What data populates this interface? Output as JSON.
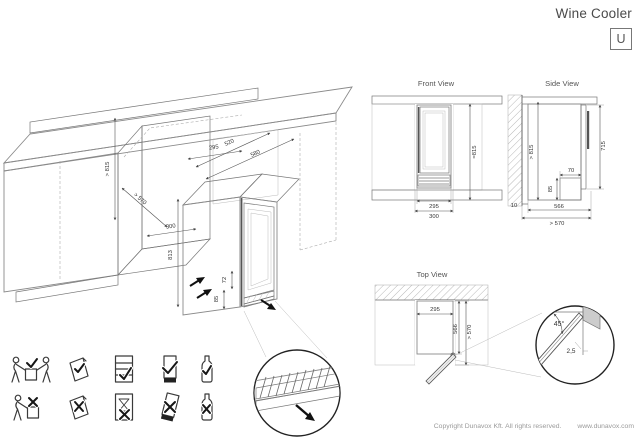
{
  "header": {
    "title": "Wine Cooler",
    "model_letter": "U"
  },
  "isometric": {
    "dim_niche_height": "> 815",
    "dim_niche_depth": "> 570",
    "dim_niche_width": "300",
    "dim_unit_width": "295",
    "dim_depth_inner": "520",
    "dim_depth_outer": "580",
    "dim_unit_height": "813",
    "dim_plinth_height": "72",
    "dim_vent_height": "85"
  },
  "front_view": {
    "title": "Front View",
    "dim_height": "≈815",
    "dim_unit_width": "295",
    "dim_niche_width": "300"
  },
  "side_view": {
    "title": "Side View",
    "dim_niche_height": "> 815",
    "dim_door_height": "715",
    "dim_vent_depth": "70",
    "dim_vent_height": "85",
    "dim_rear_gap": "10",
    "dim_unit_depth": "566",
    "dim_niche_depth": "> 570"
  },
  "top_view": {
    "title": "Top View",
    "dim_unit_width": "295",
    "dim_unit_depth": "566",
    "dim_niche_depth": "> 570"
  },
  "door_detail": {
    "open_angle": "45°",
    "clearance": "2,5"
  },
  "pictograms": [
    {
      "name": "two-person-carry",
      "allowed": true
    },
    {
      "name": "one-person-carry",
      "allowed": false
    },
    {
      "name": "panel-handling",
      "allowed": true
    },
    {
      "name": "panel-handling-tilted",
      "allowed": false
    },
    {
      "name": "cabinet-loaded",
      "allowed": true
    },
    {
      "name": "cabinet-wait-hourglass",
      "allowed": false
    },
    {
      "name": "transport-upright",
      "allowed": true
    },
    {
      "name": "transport-tilted",
      "allowed": false
    },
    {
      "name": "bottle-upright",
      "allowed": true
    },
    {
      "name": "bottle-tilted",
      "allowed": false
    }
  ],
  "footer": {
    "copyright": "Copyright Dunavox Kft. All rights reserved.",
    "website": "www.dunavox.com"
  }
}
